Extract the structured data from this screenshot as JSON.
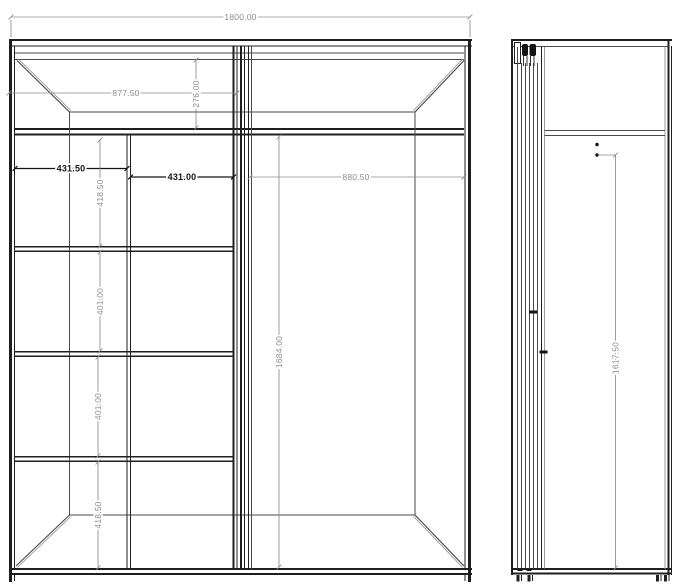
{
  "drawing": {
    "front_view": {
      "dims": {
        "overall_width": "1800.00",
        "left_section_width": "877.50",
        "top_compartment_height": "276.00",
        "left_column_width": "431.50",
        "center_column_width": "431.00",
        "open_section_width": "880.50",
        "row1_height": "418.50",
        "row2_height": "401.00",
        "row3_height": "401.00",
        "row4_height": "418.50",
        "open_section_height": "1684.00"
      }
    },
    "side_view": {
      "dims": {
        "interior_height": "1617.50"
      }
    },
    "colors": {
      "line_dark": "#1f1f1f",
      "line_mid": "#4a4a4a",
      "line_light": "#9a9a9a",
      "dim_gray": "#8c8c8c",
      "dim_black": "#141414",
      "background": "#ffffff"
    }
  }
}
